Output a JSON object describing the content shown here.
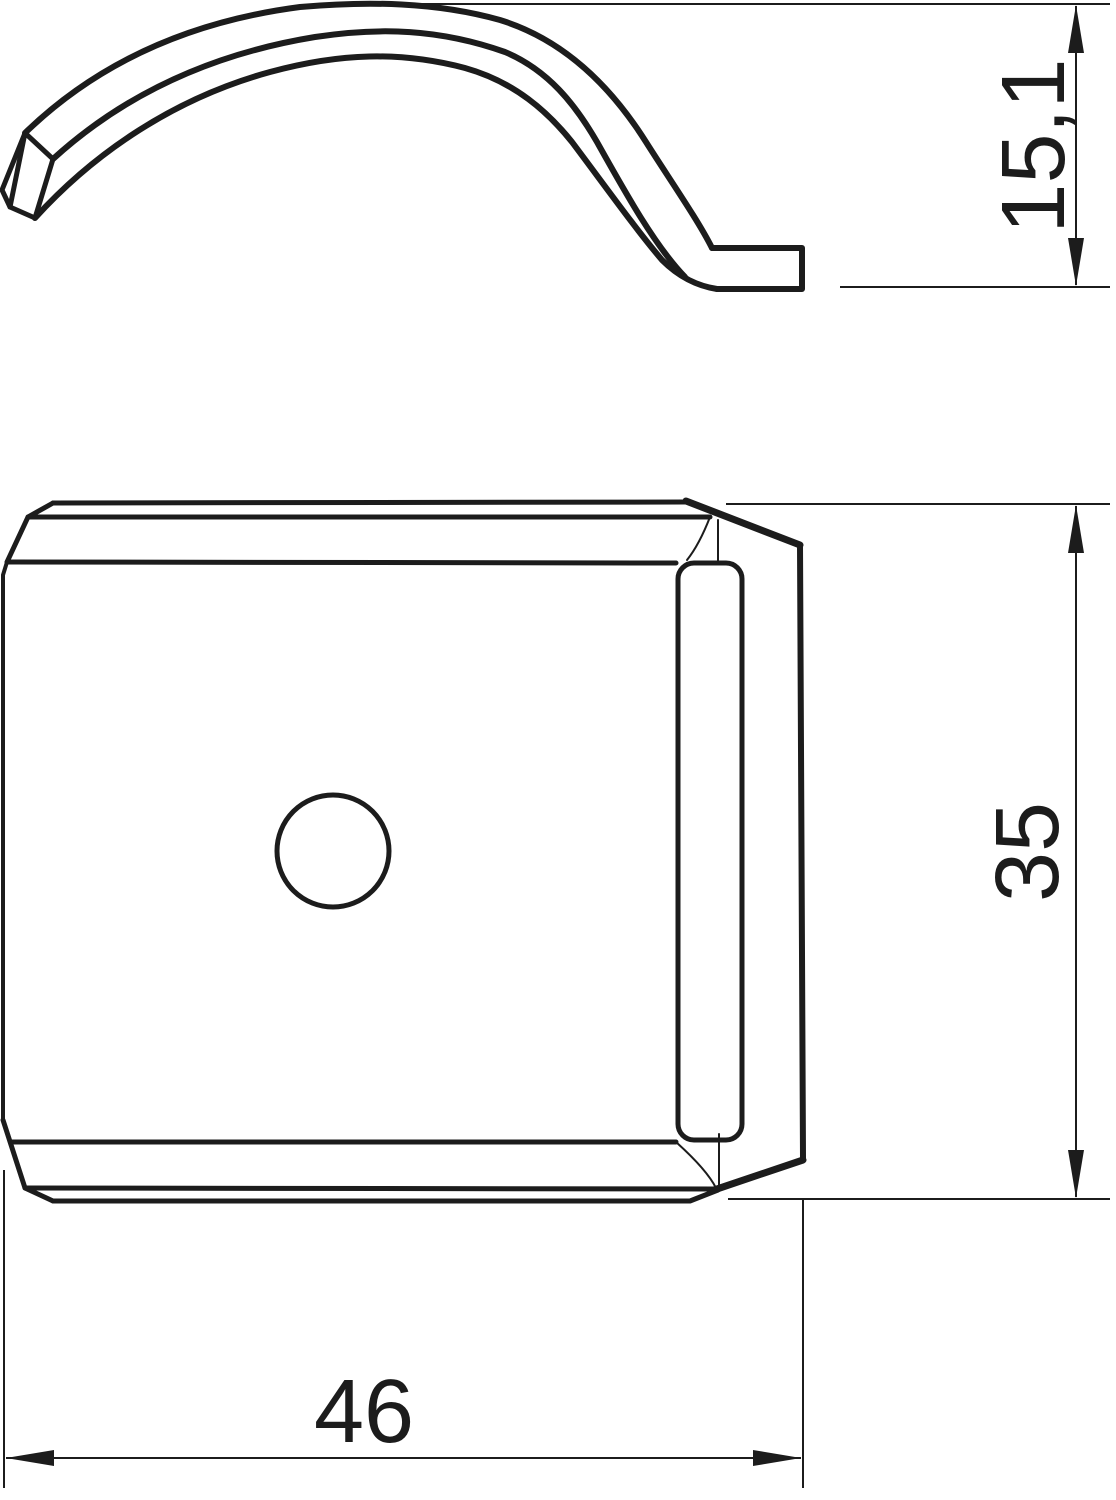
{
  "drawing": {
    "background": "#ffffff",
    "line_color": "#1c1c1c",
    "dimensions": {
      "height": {
        "label": "15,1",
        "orientation": "vertical"
      },
      "plate_height": {
        "label": "35",
        "orientation": "vertical"
      },
      "plate_width": {
        "label": "46",
        "orientation": "horizontal"
      }
    }
  }
}
